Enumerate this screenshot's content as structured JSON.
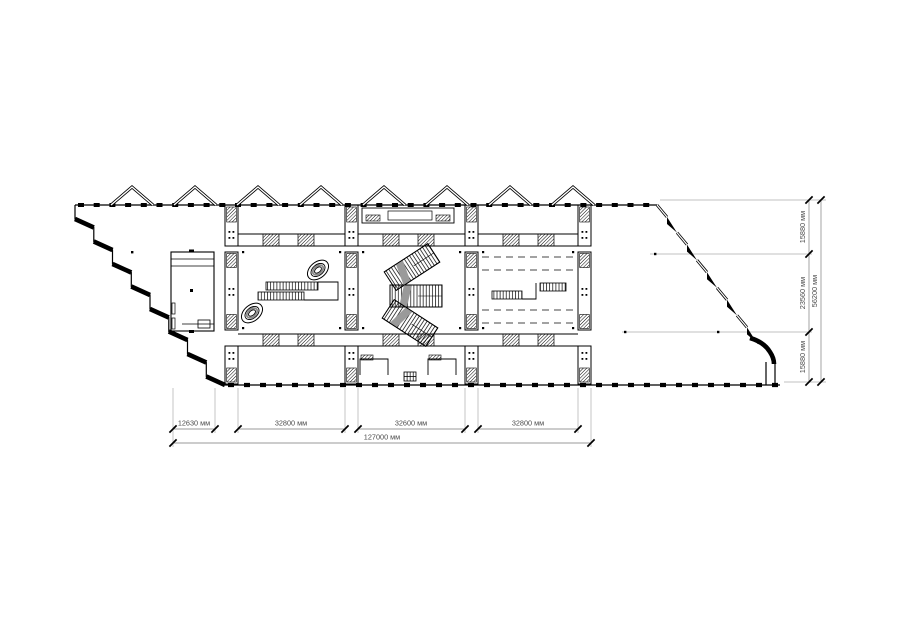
{
  "document": {
    "kind": "architectural-floor-plan",
    "units": "мм"
  },
  "dimensions": {
    "bottom_segments": [
      {
        "label": "12630 мм"
      },
      {
        "label": "32800 мм"
      },
      {
        "label": "32600 мм"
      },
      {
        "label": "32800 мм"
      }
    ],
    "bottom_total": {
      "label": "127000 мм"
    },
    "right_segments": [
      {
        "label": "15880 мм"
      },
      {
        "label": "23560 мм"
      },
      {
        "label": "15880 мм"
      }
    ],
    "right_total": {
      "label": "56200 мм"
    }
  },
  "colors": {
    "line": "#000000",
    "extension_line": "#c0c0c0",
    "dimension_line": "#9a9a9a",
    "label_text": "#4a4a4a",
    "background": "#ffffff"
  }
}
